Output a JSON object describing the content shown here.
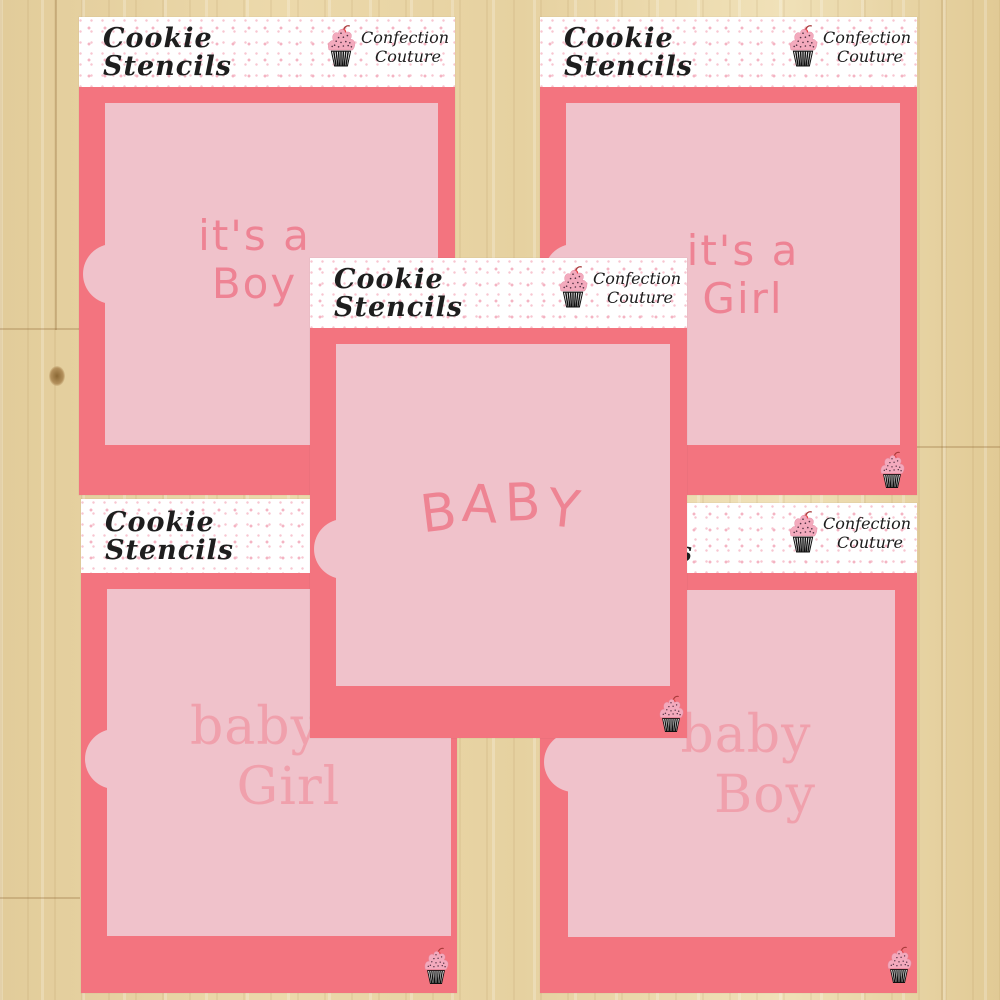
{
  "brand": {
    "line1": "Cookie",
    "line2": "Stencils"
  },
  "logo": {
    "line1": "Confection",
    "line2": "Couture"
  },
  "colors": {
    "sheet_coral": "#f3747f",
    "stencil_window_pink": "#f0c2cb",
    "design_text_bright": "#ee8394",
    "design_text_soft": "#f0a0ac",
    "header_background": "#ffffff",
    "header_dot_pink": "#f4b4c3",
    "wood_surface": "#e7d3a3",
    "cupcake_frosting": "#f3aabd",
    "cupcake_cherry": "#e23f3f",
    "logo_text_black": "#1b1b1b"
  },
  "stencils": [
    {
      "name": "its-a-boy",
      "word": [
        "it's a",
        "Boy"
      ]
    },
    {
      "name": "its-a-girl",
      "word": [
        "it's a",
        "Girl"
      ]
    },
    {
      "name": "baby",
      "word": [
        "BABY"
      ]
    },
    {
      "name": "baby-girl",
      "word": [
        "baby",
        "Girl"
      ]
    },
    {
      "name": "baby-boy",
      "word": [
        "baby",
        "Boy"
      ]
    }
  ]
}
